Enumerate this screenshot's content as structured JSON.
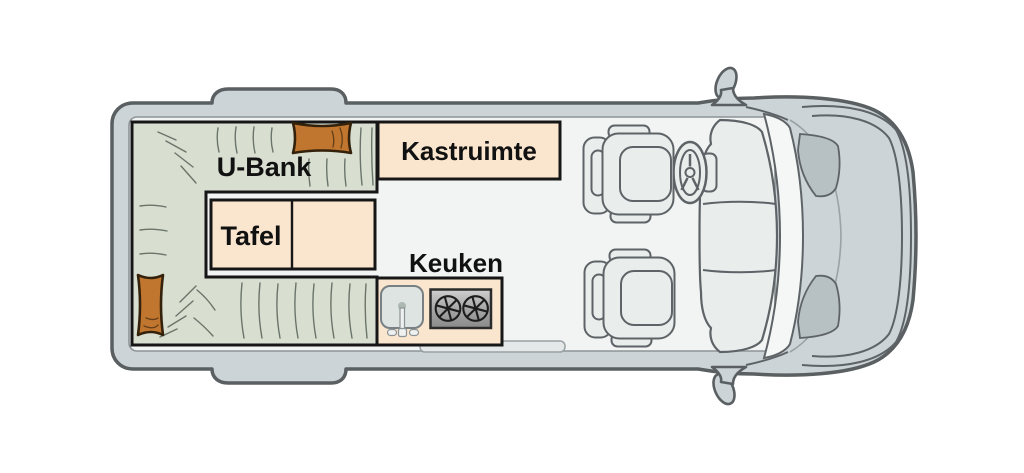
{
  "van": {
    "view": "camper-van-floorplan-top-view",
    "areas": [
      {
        "name": "u-bank-bench",
        "label": "U-Bank"
      },
      {
        "name": "kastruimte-cabinet",
        "label": "Kastruimte"
      },
      {
        "name": "tafel-table",
        "label": "Tafel"
      },
      {
        "name": "keuken-kitchen",
        "label": "Keuken"
      }
    ],
    "fixtures": [
      "pillow-top",
      "pillow-left",
      "sink",
      "stove-two-burners",
      "entry-step",
      "driver-seat",
      "passenger-seat",
      "steering-wheel",
      "dashboard",
      "windshield",
      "hood",
      "side-mirror-top",
      "side-mirror-bottom"
    ],
    "colors": {
      "body": "#cdd4d7",
      "body-outline": "#5a5f62",
      "floor": "#f2f4f3",
      "floor-outline": "#8d9497",
      "bench-green": "#d8dfd1",
      "stitch": "#6b746b",
      "furniture-outline": "#161616",
      "cream": "#fae6cf",
      "pillow": "#c0762f",
      "pillow-outline": "#33210b",
      "sink": "#dde4e1",
      "sink-outline": "#798084",
      "stove-light": "#cfcfcf",
      "stove-dark": "#8a8a8a",
      "stove-outline": "#2b2b2b",
      "cab-fill": "#e9edec",
      "cab-outline": "#5d6366",
      "glass": "#f5f7f6",
      "fender": "#b7c1c3",
      "step": "#e4e8e9",
      "label-text": "#111111"
    }
  }
}
